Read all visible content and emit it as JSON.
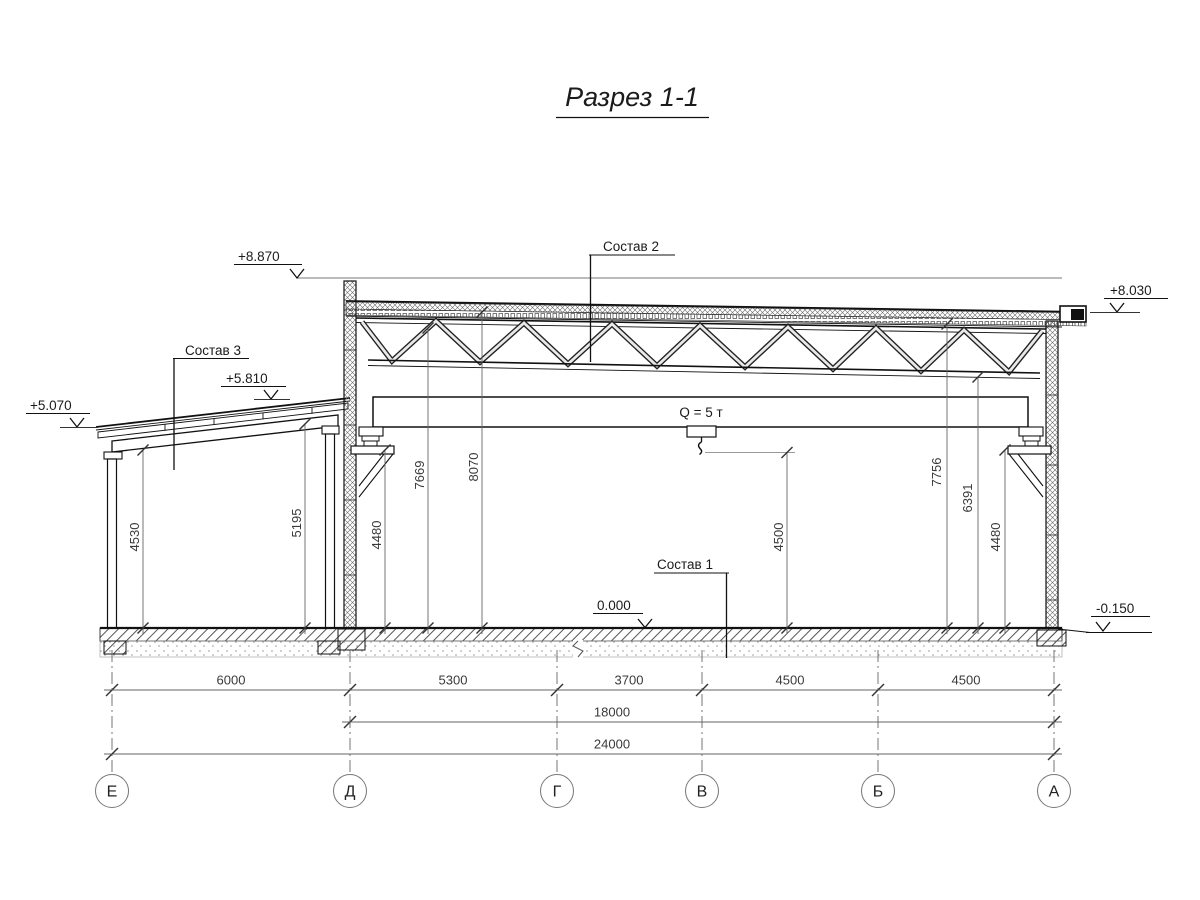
{
  "section": {
    "title": "Разрез 1-1",
    "labels": {
      "sostav1": "Состав 1",
      "sostav2": "Состав 2",
      "sostav3": "Состав 3"
    },
    "crane": {
      "label": "Q = 5 т"
    },
    "elevations": {
      "parapet": "+8.870",
      "eave_right": "+8.030",
      "annex_high": "+5.810",
      "annex_low": "+5.070",
      "floor": "0.000",
      "ground": "-0.150"
    },
    "dims_vertical": [
      "4530",
      "5195",
      "4480",
      "7669",
      "8070",
      "4500",
      "7756",
      "6391",
      "4480"
    ],
    "dims_horizontal": {
      "spans": [
        "6000",
        "5300",
        "3700",
        "4500",
        "4500"
      ],
      "middle": "18000",
      "overall": "24000"
    },
    "axes": [
      "Е",
      "Д",
      "Г",
      "В",
      "Б",
      "А"
    ]
  }
}
